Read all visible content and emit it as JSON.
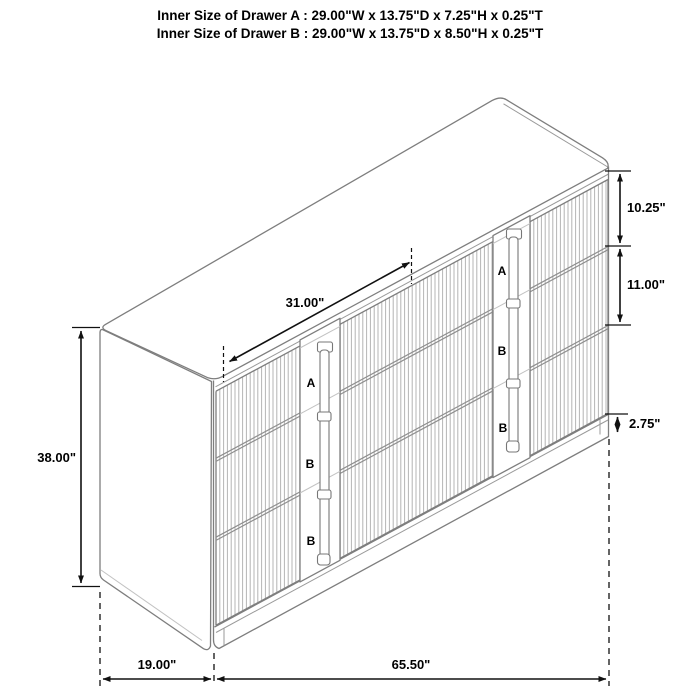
{
  "title": {
    "line1": "Inner Size of Drawer A : 29.00\"W x 13.75\"D x 7.25\"H x 0.25\"T",
    "line2": "Inner Size of Drawer B : 29.00\"W x 13.75\"D x 8.50\"H x 0.25\"T"
  },
  "dimensions": {
    "top_width": "31.00\"",
    "drawer_a_height": "10.25\"",
    "drawer_b_height": "11.00\"",
    "plinth_height": "2.75\"",
    "overall_height": "38.00\"",
    "overall_depth": "19.00\"",
    "overall_width": "65.50\""
  },
  "drawer_labels": {
    "left": [
      "A",
      "B",
      "B"
    ],
    "right": [
      "A",
      "B",
      "B"
    ]
  },
  "colors": {
    "label_red": "#e3211a",
    "line_gray": "#7e7e7e",
    "dimension_black": "#111111",
    "background": "#ffffff"
  }
}
